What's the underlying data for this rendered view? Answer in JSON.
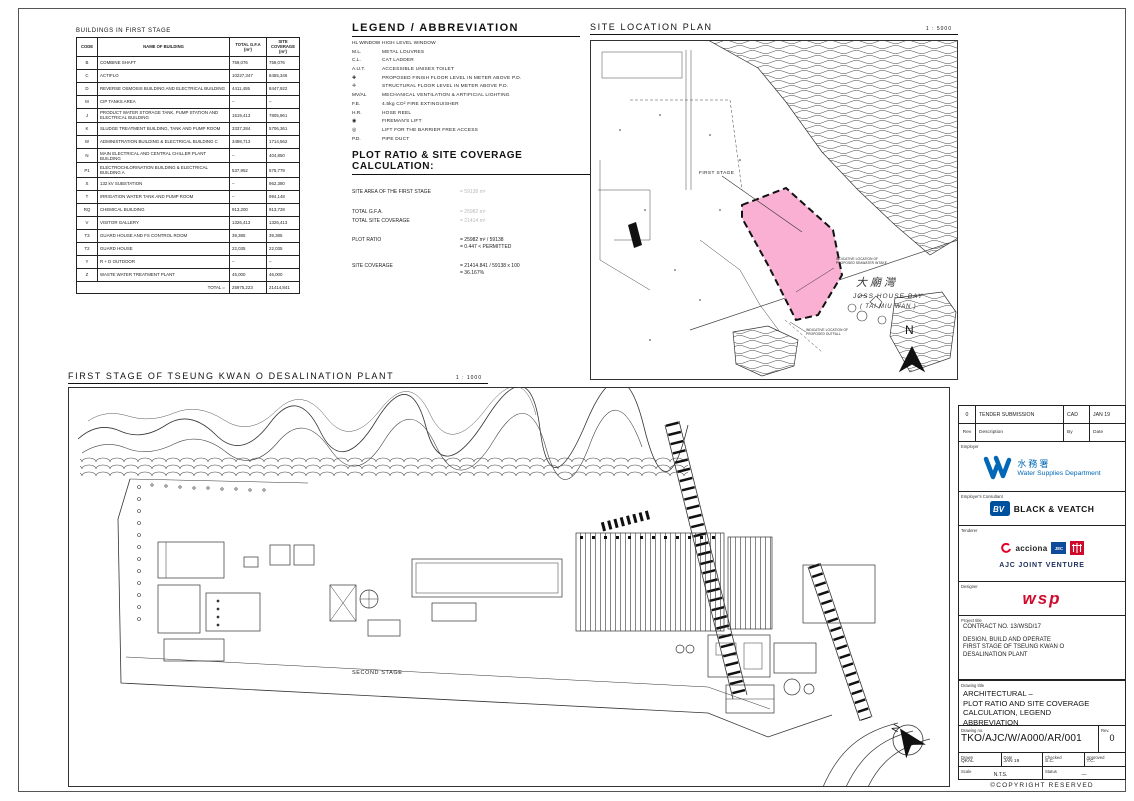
{
  "sheet": {
    "copyright": "©COPYRIGHT RESERVED"
  },
  "buildings_table": {
    "title": "BUILDINGS IN FIRST STAGE",
    "headers": [
      "CODE",
      "NAME OF BUILDING",
      "TOTAL G.F.A (m²)",
      "SITE COVERAGE (m²)"
    ],
    "rows": [
      [
        "B",
        "COMBINE SHAFT",
        "759,076",
        "759,076"
      ],
      [
        "C",
        "ACTIFLO",
        "10227,347",
        "8455,346"
      ],
      [
        "D",
        "REVERSE OSMOSIS BUILDING AND ELECTRICAL BUILDING",
        "4411,455",
        "8447,922"
      ],
      [
        "M",
        "CIP TANKS AREA",
        "–",
        "–"
      ],
      [
        "J",
        "PRODUCT WATER STORAGE TANK, PUMP STATION AND ELECTRICAL BUILDING",
        "1519,413",
        "7805,961"
      ],
      [
        "K",
        "SLUDGE TREATMENT BUILDING, TANK AND PUMP ROOM",
        "3337,284",
        "5706,361"
      ],
      [
        "W",
        "ADMINISTRATION BUILDING & ELECTRICAL BUILDING C",
        "3498,713",
        "1714,562"
      ],
      [
        "N",
        "MAIN ELECTRICAL AND CENTRAL CHILLER PLANT BUILDING",
        "–",
        "404,850"
      ],
      [
        "P1",
        "ELECTROCHLORINATION BUILDING & ELECTRICAL BUILDING A",
        "537,952",
        "575,779"
      ],
      [
        "S",
        "132 kV SUBSTATION",
        "–",
        "962,380"
      ],
      [
        "T",
        "IRRIGATION WATER TANK AND PUMP ROOM",
        "–",
        "994,148"
      ],
      [
        "RQ",
        "CHEMICAL BUILDING",
        "913,200",
        "913,728"
      ],
      [
        "V",
        "VISITOR GALLERY",
        "1326,413",
        "1326,413"
      ],
      [
        "T3",
        "GUARD HOUSE AND FS CONTROL ROOM",
        "39,385",
        "39,385"
      ],
      [
        "T2",
        "GUARD HOUSE",
        "22,035",
        "22,035"
      ],
      [
        "Y",
        "R + D OUTDOOR",
        "–",
        "–"
      ],
      [
        "Z",
        "WASTE WATER TREATMENT PLANT",
        "45,000",
        "46,000"
      ]
    ],
    "total_label": "TOTAL =",
    "total_gfa": "25975,223",
    "total_site_coverage": "21414,841"
  },
  "legend": {
    "title": "LEGEND / ABBREVIATION",
    "items": [
      {
        "sym": "HL WINDOW",
        "desc": "HIGH LEVEL WINDOW"
      },
      {
        "sym": "M.L.",
        "desc": "METAL LOUVRES"
      },
      {
        "sym": "C.L.",
        "desc": "CAT LADDER"
      },
      {
        "sym": "A.U.T.",
        "desc": "ACCESSIBLE UNISEX TOILET"
      },
      {
        "sym": "✚",
        "desc": "PROPOSED FINISH FLOOR LEVEL IN METER ABOVE P.D."
      },
      {
        "sym": "✛",
        "desc": "STRUCTURAL FLOOR LEVEL IN METER ABOVE P.D."
      },
      {
        "sym": "MV/AL",
        "desc": "MECHANICAL VENTILATION & ARTIFICIAL LIGHTING"
      },
      {
        "sym": "F.E.",
        "desc": "4.5kg CO² FIRE EXTINGUISHER"
      },
      {
        "sym": "H.R.",
        "desc": "HOSE REEL"
      },
      {
        "sym": "◉",
        "desc": "FIREMAN'S LIFT"
      },
      {
        "sym": "◎",
        "desc": "LIFT FOR THE BARRIER FREE ACCESS"
      },
      {
        "sym": "P.D.",
        "desc": "PIPE DUCT"
      }
    ]
  },
  "plot_calc": {
    "title": "PLOT RATIO & SITE COVERAGE CALCULATION:",
    "site_area_label": "SITE AREA OF THE FIRST STAGE",
    "site_area_value": "=  59138 m²",
    "gfa_label": "TOTAL G.F.A.",
    "gfa_value": "=  25982 m²",
    "tsc_label": "TOTAL SITE COVERAGE",
    "tsc_value": "=  21414 m²",
    "plot_ratio_label": "PLOT RATIO",
    "plot_ratio_line1": "=  25982 m² / 59138",
    "plot_ratio_line2": "=  0.447  <  PERMITTED",
    "sc_label": "SITE COVERAGE",
    "sc_line1": "=  21414.841 / 59138 x 100",
    "sc_line2": "=  36.167%"
  },
  "site_location": {
    "title": "SITE LOCATION PLAN",
    "scale": "1 : 5000",
    "first_stage": "FIRST STAGE",
    "bay_cn": "大廟灣",
    "bay_en": "JOSS HOUSE BAY",
    "bay_en2": "( TAI MIU WAN )",
    "note_intake": "INDICATIVE LOCATION OF PROPOSED SEAWATER INTAKE",
    "note_outfall": "INDICATIVE LOCATION OF PROPOSED OUTFALL",
    "north": "N",
    "area_color": "#f9b0d2"
  },
  "main_plan": {
    "title": "FIRST STAGE OF TSEUNG KWAN O DESALINATION PLANT",
    "scale": "1 : 1000",
    "second_stage": "SECOND STAGE",
    "north": "N"
  },
  "title_block": {
    "revision": {
      "rev": "0",
      "description": "TENDER SUBMISSION",
      "by": "CAD",
      "date": "JAN 19",
      "h_rev": "Rev",
      "h_desc": "Description",
      "h_by": "By",
      "h_date": "Date"
    },
    "employer": {
      "label": "Employer",
      "cn": "水務署",
      "name": "Water Supplies Department",
      "color": "#0068b7"
    },
    "consultant": {
      "label": "Employer's Consultant",
      "name": "BLACK & VEATCH",
      "mark": "BV"
    },
    "tenderer": {
      "label": "Tenderer",
      "acciona": "acciona",
      "jec": "JEC",
      "name": "AJC JOINT VENTURE"
    },
    "designer": {
      "label": "Designer",
      "name": "wsp",
      "color": "#cf0a2c"
    },
    "project": {
      "label": "Project title",
      "line1": "CONTRACT NO. 13/WSD/17",
      "line2": "DESIGN, BUILD AND OPERATE",
      "line3": "FIRST STAGE OF TSEUNG KWAN O",
      "line4": "DESALINATION PLANT"
    },
    "drawing_title": {
      "label": "Drawing title",
      "line1": "ARCHITECTURAL –",
      "line2": "PLOT RATIO AND SITE COVERAGE",
      "line3": "CALCULATION, LEGEND",
      "line4": "ABBREVIATION"
    },
    "drawing_no": {
      "label": "Drawing no.",
      "value": "TKO/AJC/W/A000/AR/001",
      "rev_label": "Rev.",
      "rev": "0"
    },
    "meta": {
      "drawn_label": "Drawn",
      "drawn": "QKAL",
      "date_label": "Date",
      "date": "JAN 19",
      "checked_label": "Checked",
      "checked": "S.C.",
      "approved_label": "Approved",
      "approved": "T.C.",
      "scale_label": "Scale",
      "scale": "N.T.S.",
      "status_label": "Status",
      "status": "—"
    }
  }
}
